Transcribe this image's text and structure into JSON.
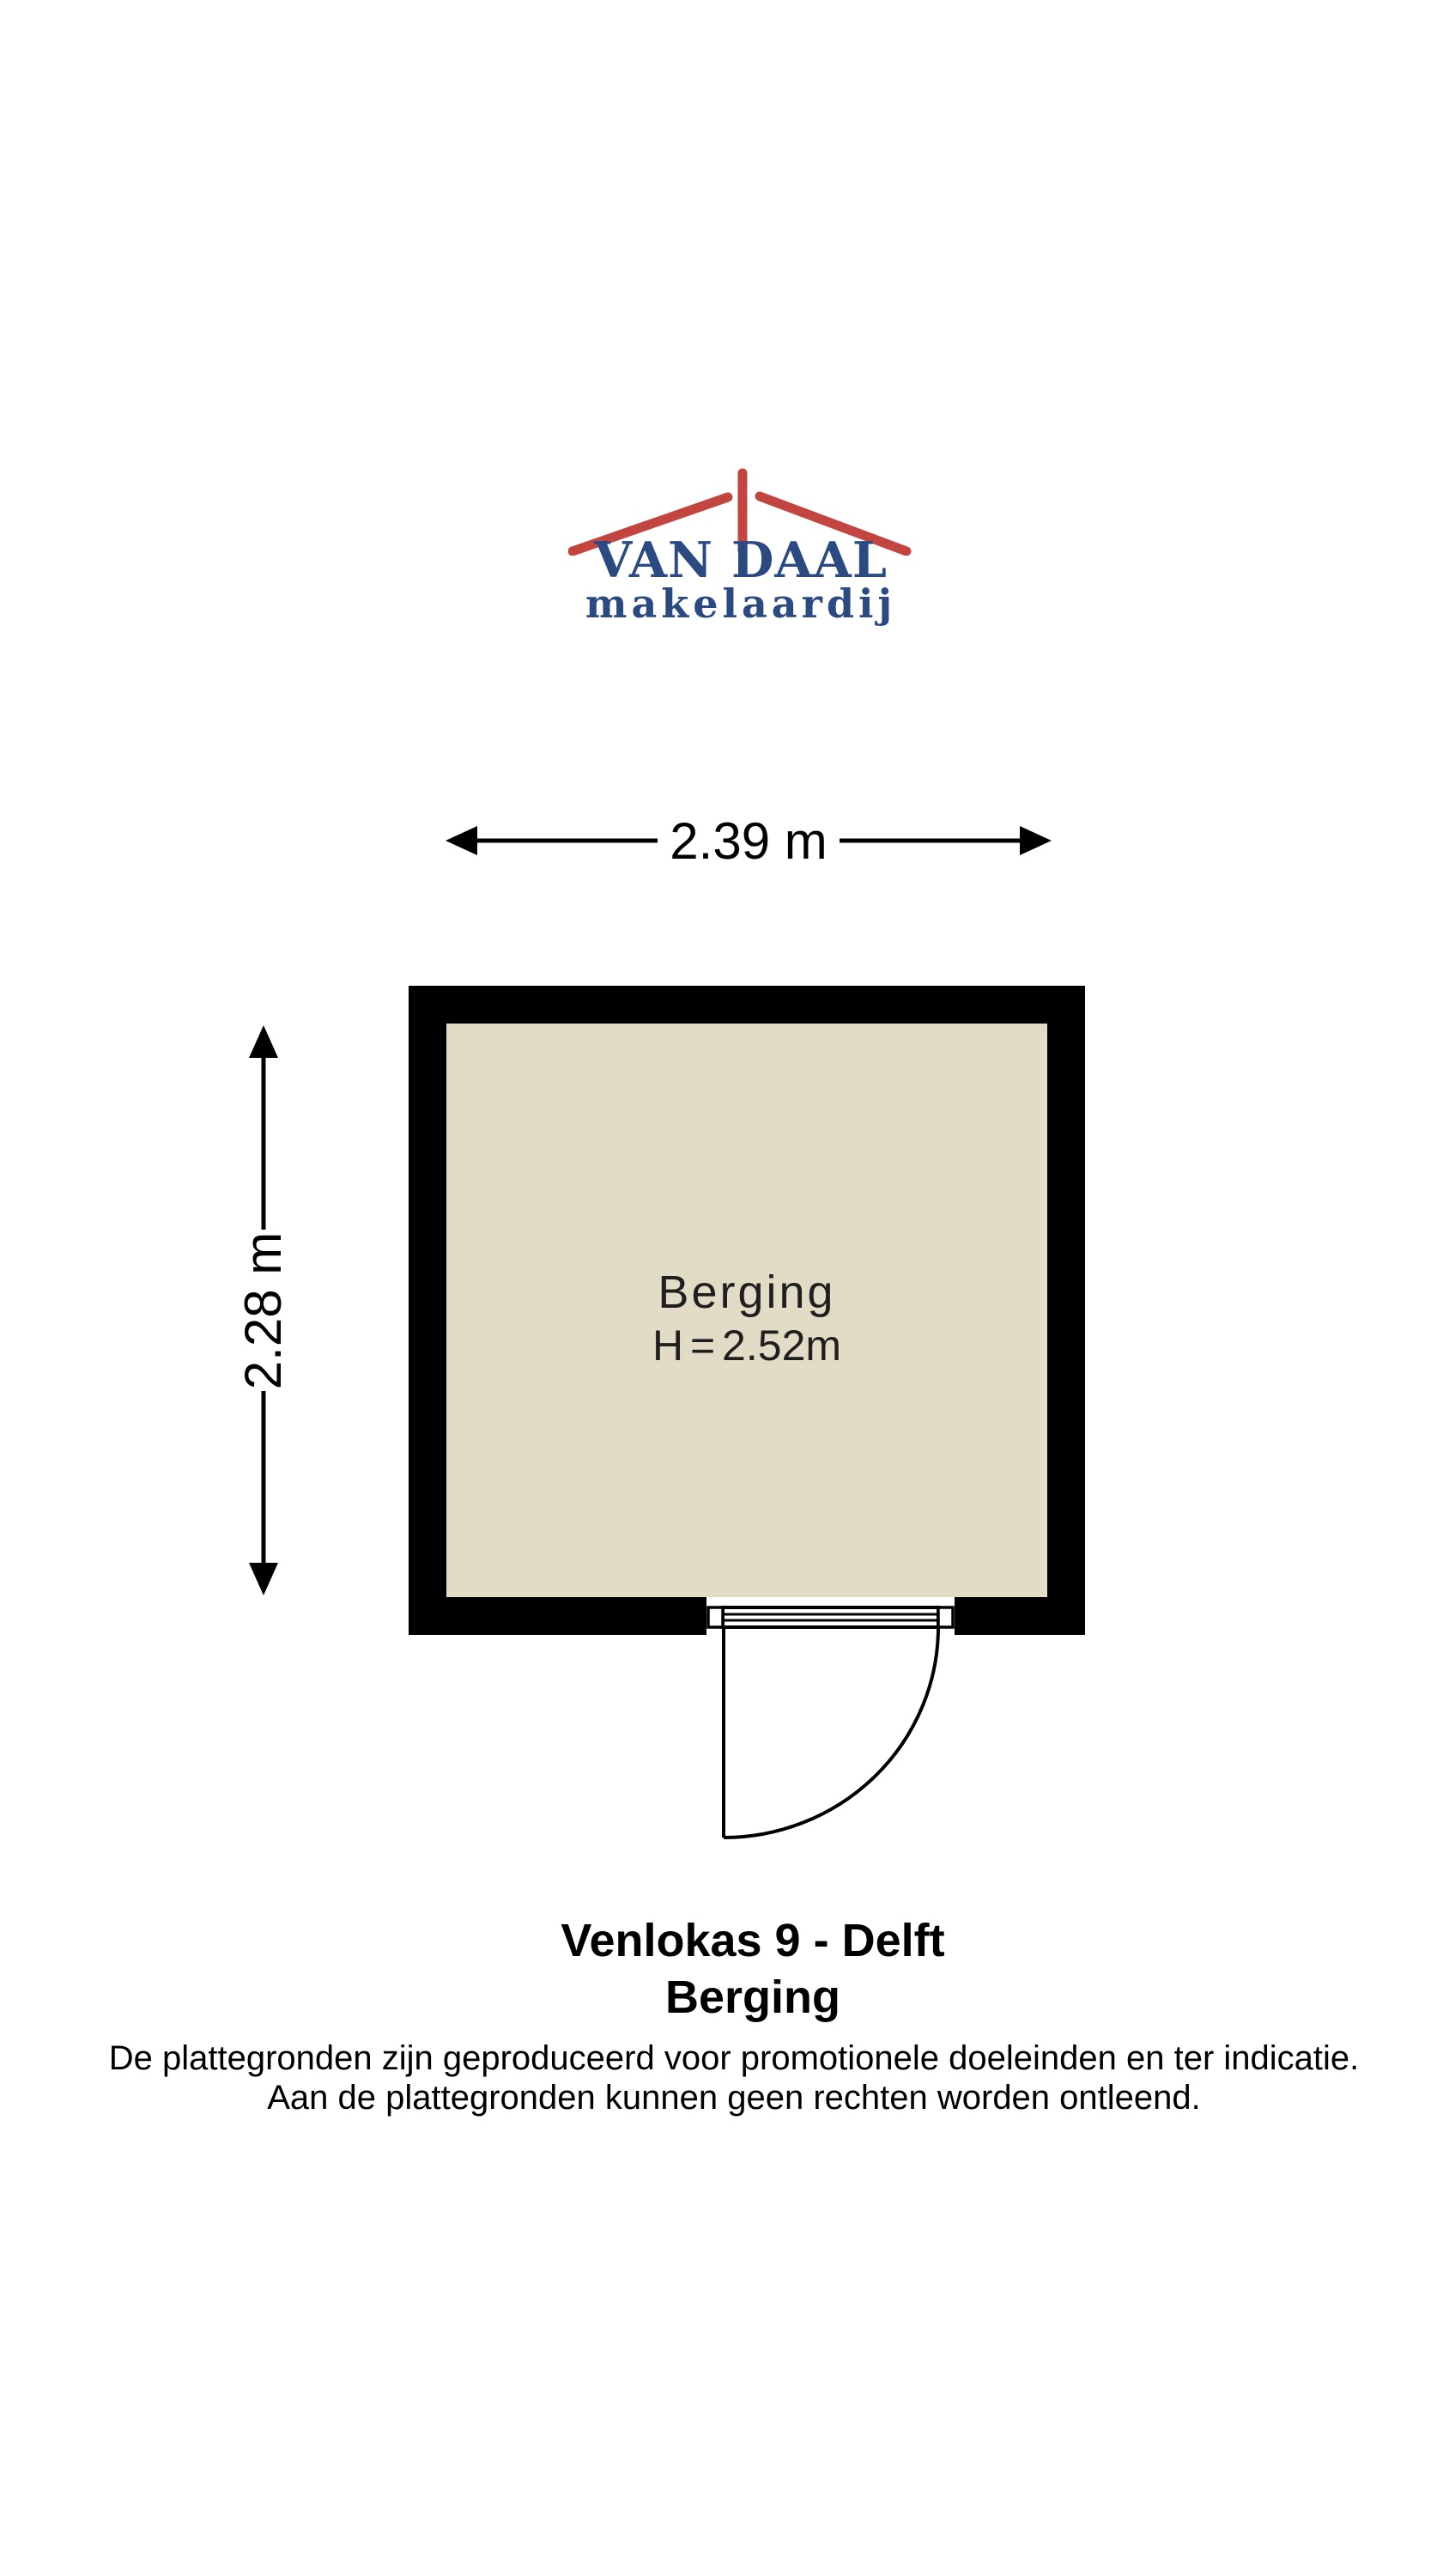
{
  "colors": {
    "background": "#ffffff",
    "wall": "#000000",
    "floor": "#e2dbc5",
    "logo_blue": "#2b4a82",
    "logo_red": "#c2453f",
    "line": "#000000"
  },
  "logo": {
    "name": "VAN DAAL",
    "subtitle": "makelaardij",
    "roof_icon": "roof-with-chimney"
  },
  "dimensions": {
    "width_label": "2.39 m",
    "height_label": "2.28 m"
  },
  "room": {
    "name": "Berging",
    "ceiling_height": "H = 2.52m"
  },
  "title": {
    "address": "Venlokas 9 - Delft",
    "room": "Berging"
  },
  "disclaimer": {
    "line1": "De plattegronden zijn geproduceerd voor promotionele doeleinden en ter indicatie.",
    "line2": "Aan de plattegronden kunnen geen rechten worden ontleend."
  }
}
